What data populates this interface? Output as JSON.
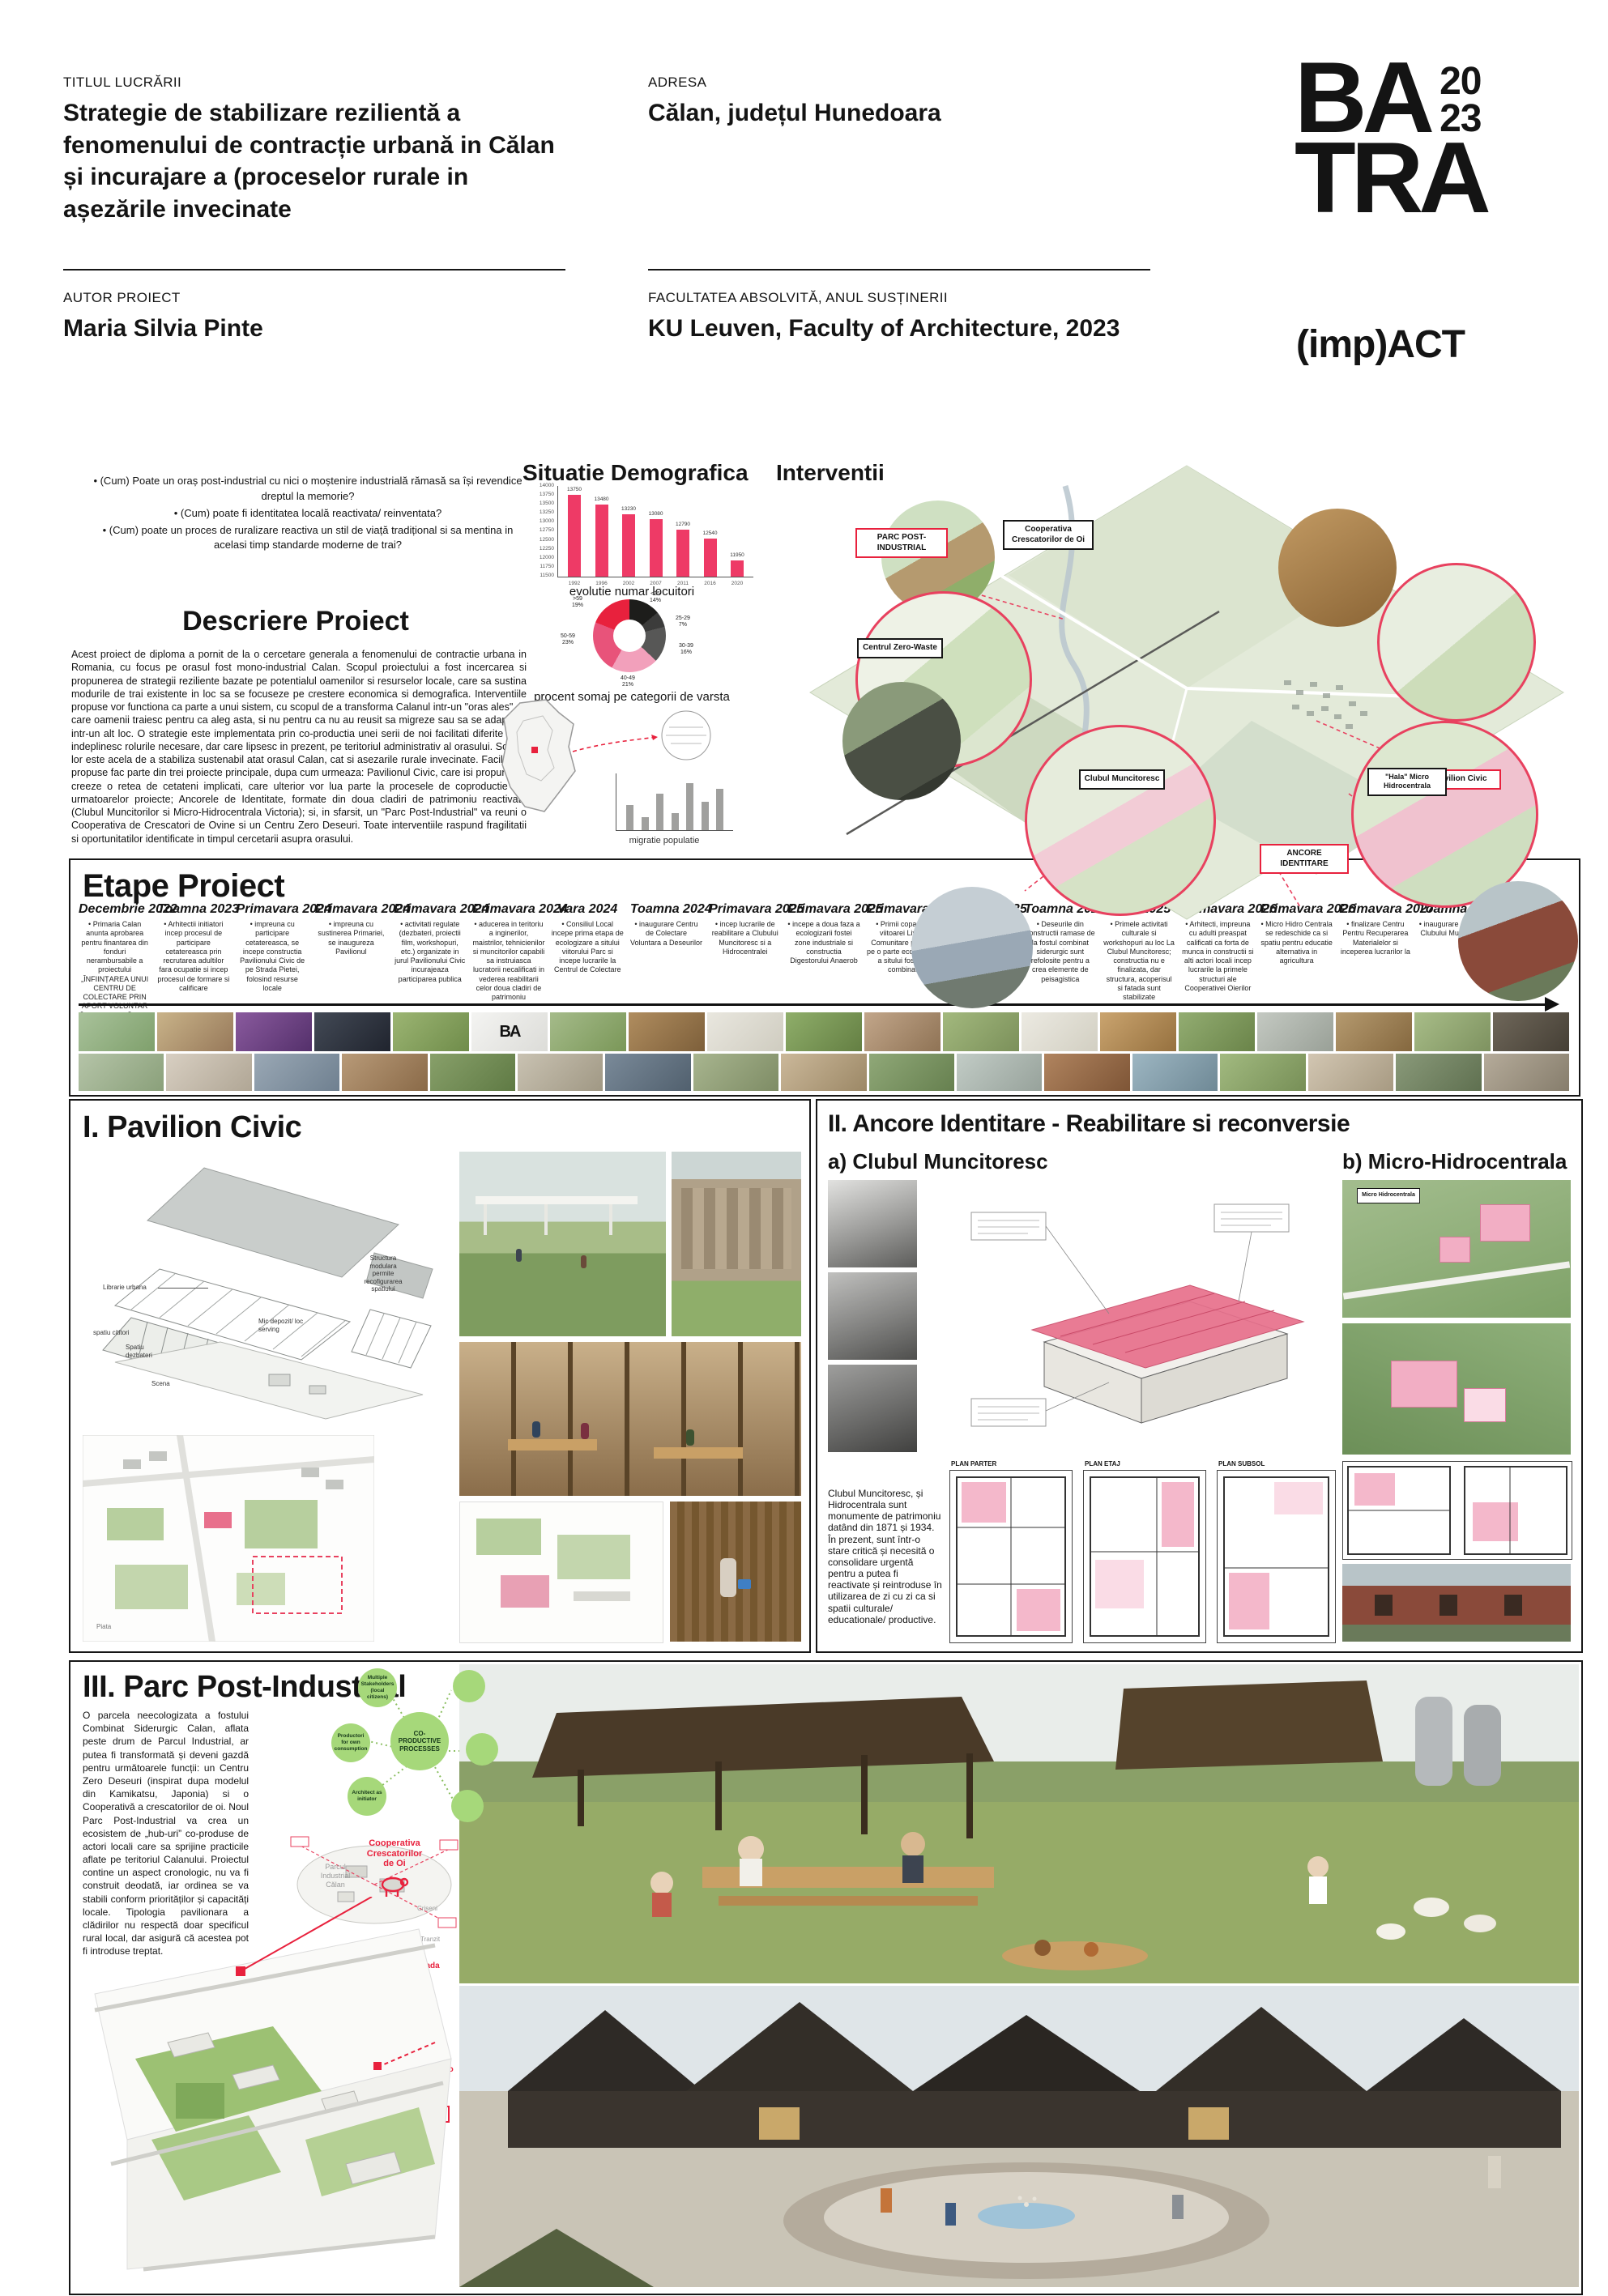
{
  "accent": {
    "pink": "#ee3a66",
    "red": "#e8213d",
    "black": "#161616",
    "green": "#a6d87a"
  },
  "header": {
    "title_label": "TITLUL LUCRĂRII",
    "title": "Strategie de stabilizare rezilientă a fenomenului de contracție urbană in Călan și incurajare a (proceselor rurale in așezările invecinate",
    "address_label": "ADRESA",
    "address": "Călan, județul Hunedoara",
    "author_label": "AUTOR PROIECT",
    "author": "Maria Silvia Pinte",
    "faculty_label": "FACULTATEA ABSOLVITĂ, ANUL SUSȚINERII",
    "faculty": "KU Leuven, Faculty of Architecture, 2023",
    "logo_line1": "BA",
    "logo_year_top": "20",
    "logo_year_bottom": "23",
    "logo_line2": "TRA",
    "logo_impact": "(imp)ACT"
  },
  "intro": {
    "questions": [
      "• (Cum) Poate un oraș post-industrial cu nici o moștenire industrială rămasă sa își revendice dreptul la memorie?",
      "• (Cum) poate fi identitatea locală reactivata/ reinventata?",
      "• (Cum) poate un proces de ruralizare reactiva un stil de viață tradițional si sa mentina in acelasi timp standarde moderne de trai?"
    ],
    "descriere_title": "Descriere Proiect",
    "descriere_text": "Acest proiect de diploma a pornit de la o cercetare generala a fenomenului de contractie urbana in Romania, cu focus pe orasul fost mono-industrial Calan. Scopul proiectului a fost incercarea si propunerea de strategii reziliente bazate pe potentialul oamenilor si resurselor locale, care sa sustina modurile de trai existente in loc sa se focuseze pe crestere economica si demografica. Interventiile propuse vor functiona ca parte a unui sistem, cu scopul de a transforma Calanul intr-un \"oras ales\", in care oamenii traiesc pentru ca aleg asta, si nu pentru ca nu au reusit sa migreze sau sa se adapteze intr-un alt loc. O strategie este implementata prin co-productia unei serii de noi facilitati diferite care indeplinesc rolurile necesare, dar care lipsesc in prezent, pe teritoriul administrativ al orasului. Scopul lor este acela de a stabiliza sustenabil atat orasul Calan, cat si asezarile rurale invecinate. Facilitatile propuse fac parte din trei proiecte principale, dupa cum urmeaza: Pavilionul Civic, care isi propune sa creeze o retea de cetateni implicati, care ulterior vor lua parte la procesele de coproductie ale urmatoarelor proiecte; Ancorele de Identitate, formate din doua cladiri de patrimoniu reactivate (Clubul Muncitorilor si Micro-Hidrocentrala Victoria); si, in sfarsit, un \"Parc Post-Industrial\" va reuni o Cooperativa de Crescatori de Ovine si un Centru Zero Deseuri. Toate interventiile raspund fragilitatii si oportunitatilor identificate in timpul cercetarii asupra orasului."
  },
  "chart_data": [
    {
      "type": "bar",
      "title": "Situatie Demografica",
      "caption": "evolutie numar locuitori",
      "x": [
        "1992",
        "1996",
        "2002",
        "2007",
        "2011",
        "2016",
        "2020"
      ],
      "values": [
        13750,
        13480,
        13230,
        13080,
        12790,
        12540,
        11950
      ],
      "ylim": [
        11500,
        14000
      ],
      "yticks": [
        "14000",
        "13750",
        "13500",
        "13250",
        "13000",
        "12750",
        "12500",
        "12250",
        "12000",
        "11750",
        "11500"
      ],
      "bar_color": "#ee3a66",
      "show_values": true,
      "grid": false,
      "legend": "none"
    },
    {
      "type": "pie",
      "caption": "procent somaj pe categorii de varsta",
      "slices": [
        {
          "label": "<25",
          "value": 14,
          "color": "#1d1d1b"
        },
        {
          "label": "25-29",
          "value": 7,
          "color": "#3c3c3b"
        },
        {
          "label": "30-39",
          "value": 16,
          "color": "#575756"
        },
        {
          "label": "40-49",
          "value": 21,
          "color": "#f2a0bb"
        },
        {
          "label": "50-59",
          "value": 23,
          "color": "#e8537a"
        },
        {
          "label": ">59",
          "value": 19,
          "color": "#e8213d"
        }
      ]
    },
    {
      "type": "bar",
      "caption": "migratie populatie",
      "x": [],
      "values": [
        35,
        18,
        52,
        24,
        66,
        40,
        58
      ],
      "ylim": [
        0,
        80
      ],
      "bar_color": "#a0a09e",
      "show_values": false
    }
  ],
  "interventii": {
    "title": "Interventii",
    "callouts": [
      {
        "label": "Cooperativa Crescatorilor de Oi",
        "style": "black"
      },
      {
        "label": "PARC POST-INDUSTRIAL",
        "style": "red"
      },
      {
        "label": "Centrul Zero-Waste",
        "style": "black"
      },
      {
        "label": "Pavilion Civic",
        "style": "red"
      },
      {
        "label": "Clubul Muncitoresc",
        "style": "black"
      },
      {
        "label": "\"Hala\" Micro Hidrocentrala",
        "style": "black"
      },
      {
        "label": "ANCORE IDENTITARE",
        "style": "red"
      }
    ]
  },
  "etape": {
    "title": "Etape Proiect",
    "columns": [
      {
        "date": "Decembrie 2022",
        "text": "Primaria Calan anunta aprobarea pentru finantarea din fonduri nerambursabile a proiectului „ÎNFIINȚAREA UNUI CENTRU DE COLECTARE PRIN APORT VOLUNTAR ÎN ORAȘUL CĂLAN”"
      },
      {
        "date": "Toamna 2023",
        "text": "Arhitectii initiatori incep procesul de participare cetatereasca prin recrutarea adultilor fara ocupatie si incep procesul de formare si calificare"
      },
      {
        "date": "Primavara 2024",
        "text": "impreuna cu participare cetatereasca, se incepe constructia Pavilionului Civic de pe Strada Pietei, folosind resurse locale"
      },
      {
        "date": "Primavara 2024",
        "text": "impreuna cu sustinerea Primariei, se inaugureza Pavilionul"
      },
      {
        "date": "Primavara 2024",
        "text": "activitati regulate (dezbateri, proiectii film, workshopuri, etc.) organizate in jurul Pavilionului Civic incurajeaza participarea publica"
      },
      {
        "date": "Primavara 2024",
        "text": "aducerea in teritoriu a inginerilor, maistrilor, tehnicienilor si muncitorilor capabili sa instruiasca lucratorii necalificati in vederea reabilitarii celor doua cladiri de patrimoniu"
      },
      {
        "date": "Vara 2024",
        "text": "Consiliul Local incepe prima etapa de ecologizare a sitului viitorului Parc si incepe lucrarile la Centrul de Colectare"
      },
      {
        "date": "Toamna 2024",
        "text": "inaugurare Centru de Colectare Voluntara a Deseurilor"
      },
      {
        "date": "Primavara 2025",
        "text": "incep lucrarile de reabilitare a Clubului Muncitoresc si a Hidrocentralei"
      },
      {
        "date": "Primavara 2025",
        "text": "incepe a doua faza a ecologizarii fostei zone industriale si constructia Digestorului Anaerob"
      },
      {
        "date": "Primavara 2025",
        "text": "Primii copaci ai viitoarei Livezi Comunitare plantati pe o parte ecologizata a sitului fostului combinat"
      },
      {
        "date": "Toamna 2025",
        "text": "Structurile Clubului Muncitoresc si a Hidrocentralei sunt stabilizate, astfel constructiile nu mai sunt in pericol"
      },
      {
        "date": "Toamna 2025",
        "text": "Deseurile din constructii ramase de la fostul combinat siderurgic sunt refolosite pentru a crea elemente de peisagistica"
      },
      {
        "date": "Iarna 2025",
        "text": "Primele activitati culturale si workshopuri au loc La Clubul Muncitoresc; constructia nu e finalizata, dar structura, acoperisul si fatada sunt stabilizate"
      },
      {
        "date": "Primavara 2026",
        "text": "Arhitecti, impreuna cu adulti preaspat calificati ca forta de munca in constructii si alti actori locali incep lucrarile la primele structuri ale Cooperativei Oierilor"
      },
      {
        "date": "Primavara 2026",
        "text": "Micro Hidro Centrala se redeschide ca si spatiu pentru educatie alternativa in agricultura"
      },
      {
        "date": "Primavara 2027",
        "text": "finalizare Centru Pentru Recuperarea Materialelor si inceperea lucrarilor la"
      },
      {
        "date": "Toamna 2027",
        "text": "inaugurare oficiala a Clubului Muncitoresc"
      },
      {
        "date": "Vara 2028",
        "text": "inaugurare centru de echitate"
      }
    ],
    "photos_row1": [
      {
        "a": "#a9c29b",
        "b": "#7fa06c"
      },
      {
        "a": "#c9b389",
        "b": "#97795a"
      },
      {
        "a": "#8a5a9e",
        "b": "#54306b"
      },
      {
        "a": "#434a56",
        "b": "#20242e"
      },
      {
        "a": "#9cb573",
        "b": "#6f8c4a"
      },
      {
        "a": "#f4f4f2",
        "b": "#dcdcd8",
        "t": "BA"
      },
      {
        "a": "#a5bb8a",
        "b": "#7a9758"
      },
      {
        "a": "#b08d5f",
        "b": "#7d5f3a"
      },
      {
        "a": "#e9e7df",
        "b": "#cfccc0"
      },
      {
        "a": "#8fae6a",
        "b": "#647f43"
      },
      {
        "a": "#c2a68a",
        "b": "#8f7355"
      },
      {
        "a": "#a3b97e",
        "b": "#7b905a"
      },
      {
        "a": "#eceae2",
        "b": "#d2cfc2"
      },
      {
        "a": "#caa46f",
        "b": "#96713f"
      },
      {
        "a": "#93ad72",
        "b": "#6a8449"
      },
      {
        "a": "#c4c9c2",
        "b": "#99a097"
      },
      {
        "a": "#b59a6f",
        "b": "#85683f"
      },
      {
        "a": "#a8bd88",
        "b": "#7e9260"
      },
      {
        "a": "#6f675a",
        "b": "#453f35"
      }
    ],
    "photos_row2": [
      {
        "a": "#b5c4a8",
        "b": "#8aa07a"
      },
      {
        "a": "#d8cfc2",
        "b": "#b0a695"
      },
      {
        "a": "#9aa8b5",
        "b": "#6f8090"
      },
      {
        "a": "#b89a78",
        "b": "#8a6a48"
      },
      {
        "a": "#88a06a",
        "b": "#5f7a44"
      },
      {
        "a": "#c9c2b2",
        "b": "#a09884"
      },
      {
        "a": "#7a8a99",
        "b": "#51606e"
      },
      {
        "a": "#a8b58f",
        "b": "#7e8c65"
      },
      {
        "a": "#cbb89a",
        "b": "#9c8866"
      },
      {
        "a": "#90a878",
        "b": "#66804f"
      },
      {
        "a": "#c2ccc6",
        "b": "#97a29b"
      },
      {
        "a": "#b0845f",
        "b": "#7e5536"
      },
      {
        "a": "#9db6c2",
        "b": "#6f8996"
      },
      {
        "a": "#a2ba80",
        "b": "#778f57"
      },
      {
        "a": "#d2c6b2",
        "b": "#a79a82"
      },
      {
        "a": "#8a9a7a",
        "b": "#5f7050"
      },
      {
        "a": "#b5ab9a",
        "b": "#867d6c"
      }
    ]
  },
  "pavilion": {
    "title": "I. Pavilion Civic",
    "labels": {
      "structura": "Structura modulara permite recofigurarea spatiului",
      "librarie": "Librarie urbana",
      "depozit": "Mic depozit/ loc serving",
      "dezbateri": "Spatiu dezbateri",
      "scena": "Scena",
      "cititori": "spatiu cititori",
      "piata": "Piata"
    }
  },
  "ancore": {
    "title": "II. Ancore Identitare - Reabilitare si reconversie",
    "sub_a": "a) Clubul Muncitoresc",
    "sub_b": "b) Micro-Hidrocentrala",
    "description": "Clubul Muncitoresc, și Hidrocentrala sunt monumente de patrimoniu datând din 1871 și 1934. În prezent, sunt într-o stare critică și necesită o consolidare urgentă pentru a putea fi reactivate și reintroduse în utilizarea de zi cu zi ca si spatii culturale/ educationale/ productive.",
    "plan_titles": [
      "PLAN PARTER",
      "PLAN ETAJ",
      "PLAN SUBSOL"
    ],
    "micro_label": "Micro Hidrocentrala"
  },
  "parc": {
    "title": "III. Parc Post-Industrial",
    "text": "O parcela neecologizata a fostului Combinat Siderurgic Calan, aflata peste drum de Parcul Industrial, ar putea fi transformată și deveni gazdă pentru următoarele funcții: un Centru Zero Deseuri (inspirat dupa modelul din Kamikatsu, Japonia) si o Cooperativă a crescatorilor de oi. Noul Parc Post-Industrial va crea un ecosistem de „hub-uri” co-produse de actori locali care sa sprijine practicile aflate pe teritoriul Calanului. Proiectul contine un aspect cronologic, nu va fi construit deodată, iar ordinea se va stabili conform priorităților și capacități locale. Tipologia pavilionara a clădirilor nu respectă doar specificul rural local, dar asigură că acestea pot fi introduse treptat.",
    "bubble_center": "CO- PRODUCTIVE PROCESSES",
    "bubbles": [
      "Multiple Stakeholders (local citizens)",
      "Productori for own consumption",
      "Architect as initiator"
    ],
    "labels": {
      "coop": "Cooperativa Crescatorilor de Oi",
      "parc_industrial": "Parcul Industrial Călan",
      "la_artar": "La Artar",
      "criseni": "Criseni",
      "tranzit": "Tranzit",
      "livada": "Livada",
      "zero_waste": "Centru \"Zero Waste\""
    }
  }
}
